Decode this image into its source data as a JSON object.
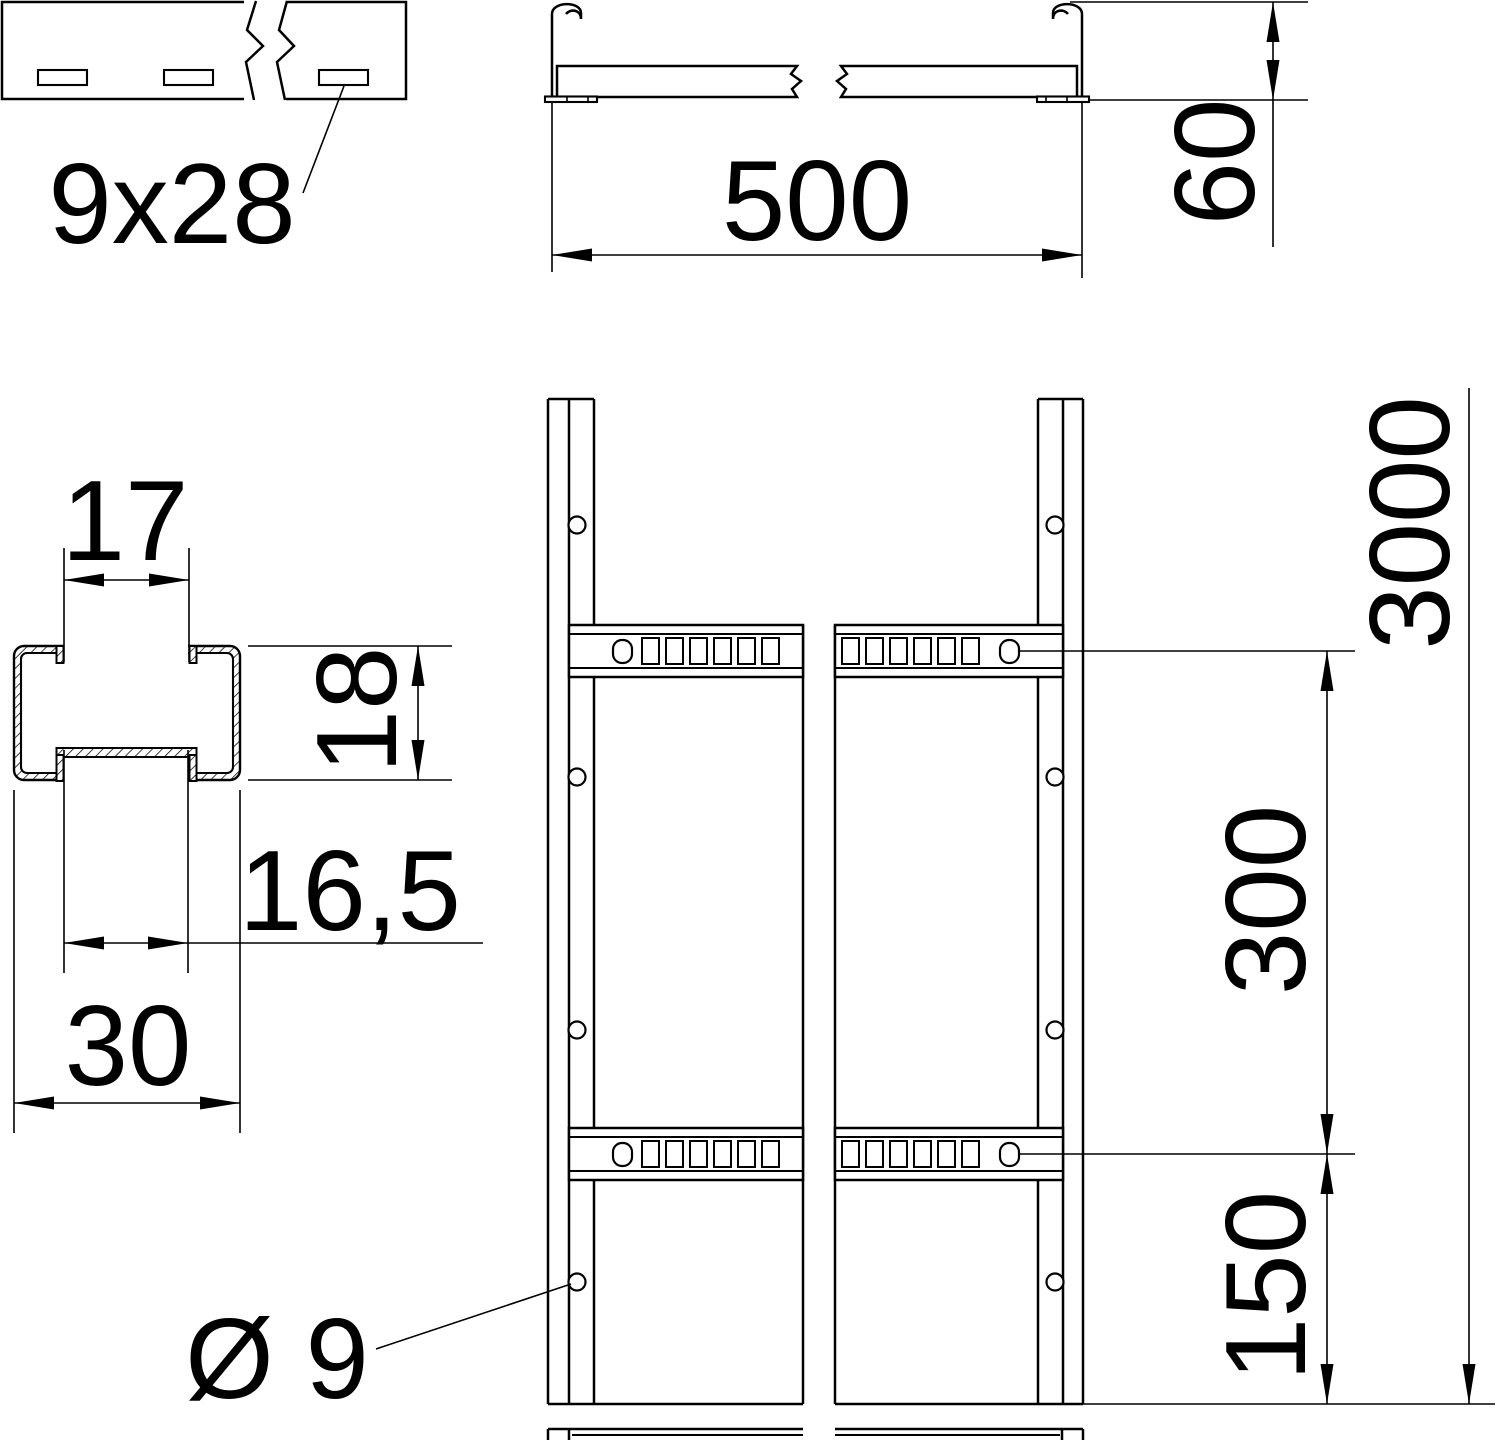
{
  "drawing": {
    "title": "cable-ladder-dimension-drawing",
    "background_color": "#ffffff",
    "line_color": "#000000",
    "views": {
      "rail_side_view": {
        "slot_label": "9x28"
      },
      "cross_section": {
        "width_label": "500",
        "height_label": "60"
      },
      "rung_profile": {
        "opening_label": "17",
        "height_label": "18",
        "recess_label": "16,5",
        "width_label": "30"
      },
      "plan_view": {
        "length_label": "3000",
        "rung_pitch_label": "300",
        "end_spacing_label": "150",
        "hole_diameter_label": "Ø 9"
      }
    }
  }
}
